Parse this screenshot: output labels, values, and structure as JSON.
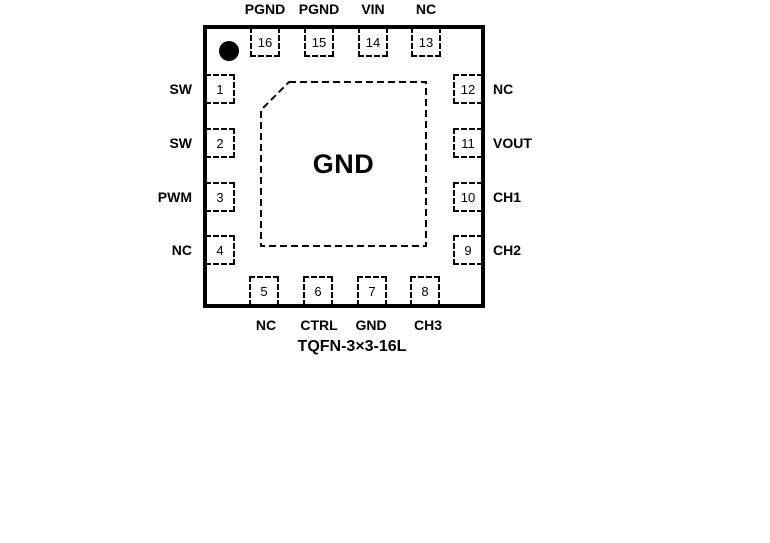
{
  "diagram": {
    "package_name": "TQFN-3×3-16L",
    "center_pad_label": "GND"
  },
  "pins": {
    "top": [
      {
        "number": "16",
        "label": "PGND"
      },
      {
        "number": "15",
        "label": "PGND"
      },
      {
        "number": "14",
        "label": "VIN"
      },
      {
        "number": "13",
        "label": "NC"
      }
    ],
    "left": [
      {
        "number": "1",
        "label": "SW"
      },
      {
        "number": "2",
        "label": "SW"
      },
      {
        "number": "3",
        "label": "PWM"
      },
      {
        "number": "4",
        "label": "NC"
      }
    ],
    "right": [
      {
        "number": "12",
        "label": "NC"
      },
      {
        "number": "11",
        "label": "VOUT"
      },
      {
        "number": "10",
        "label": "CH1"
      },
      {
        "number": "9",
        "label": "CH2"
      }
    ],
    "bottom": [
      {
        "number": "5",
        "label": "NC"
      },
      {
        "number": "6",
        "label": "CTRL"
      },
      {
        "number": "7",
        "label": "GND"
      },
      {
        "number": "8",
        "label": "CH3"
      }
    ]
  },
  "colors": {
    "ink": "#000000",
    "background": "#ffffff"
  }
}
